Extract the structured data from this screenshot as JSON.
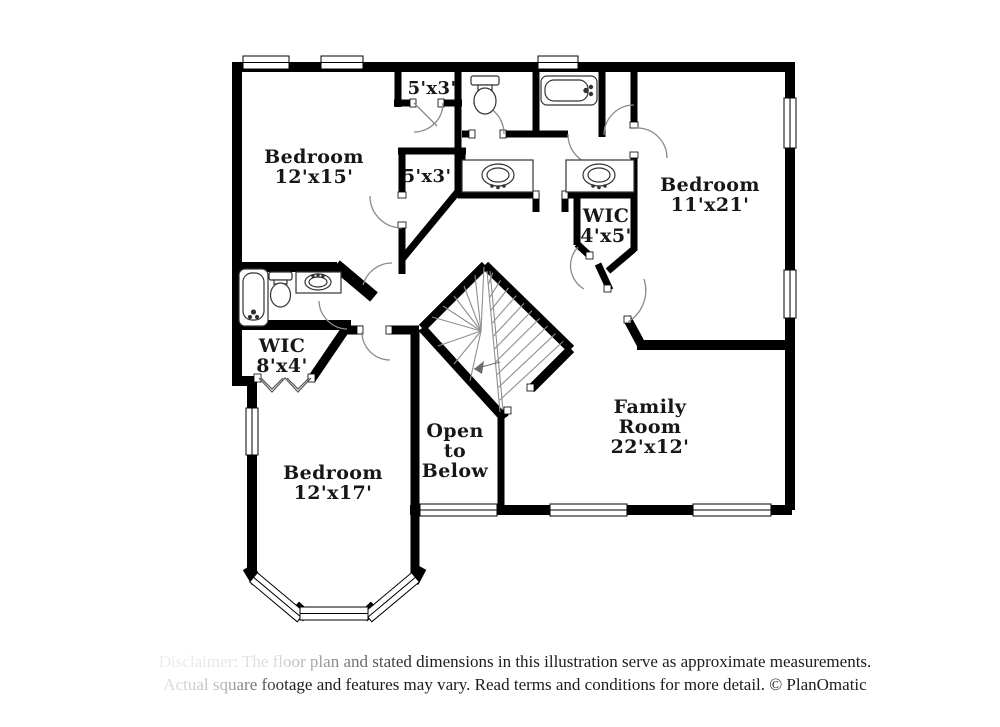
{
  "colors": {
    "wall": "#000000",
    "background": "#ffffff",
    "label": "#171717",
    "fixture_line": "#333333",
    "door_arc": "#8a8a8a"
  },
  "rooms": {
    "bedroom_top_left": {
      "name": "Bedroom",
      "dims": "12'x15'"
    },
    "closet_top": {
      "dims": "5'x3'"
    },
    "closet_mid": {
      "dims": "5'x3'"
    },
    "wic_right": {
      "name": "WIC",
      "dims": "4'x5'"
    },
    "bedroom_right": {
      "name": "Bedroom",
      "dims": "11'x21'"
    },
    "wic_left": {
      "name": "WIC",
      "dims": "8'x4'"
    },
    "bedroom_bottom": {
      "name": "Bedroom",
      "dims": "12'x17'"
    },
    "open_to_below": {
      "line1": "Open",
      "line2": "to",
      "line3": "Below"
    },
    "family_room": {
      "line1": "Family",
      "line2": "Room",
      "dims": "22'x12'"
    }
  },
  "footer": {
    "line1": "Disclaimer: The floor plan and stated dimensions in this illustration serve as approximate measurements.",
    "line2": "Actual square footage and features may vary. Read terms and conditions for more detail. © PlanOmatic"
  }
}
